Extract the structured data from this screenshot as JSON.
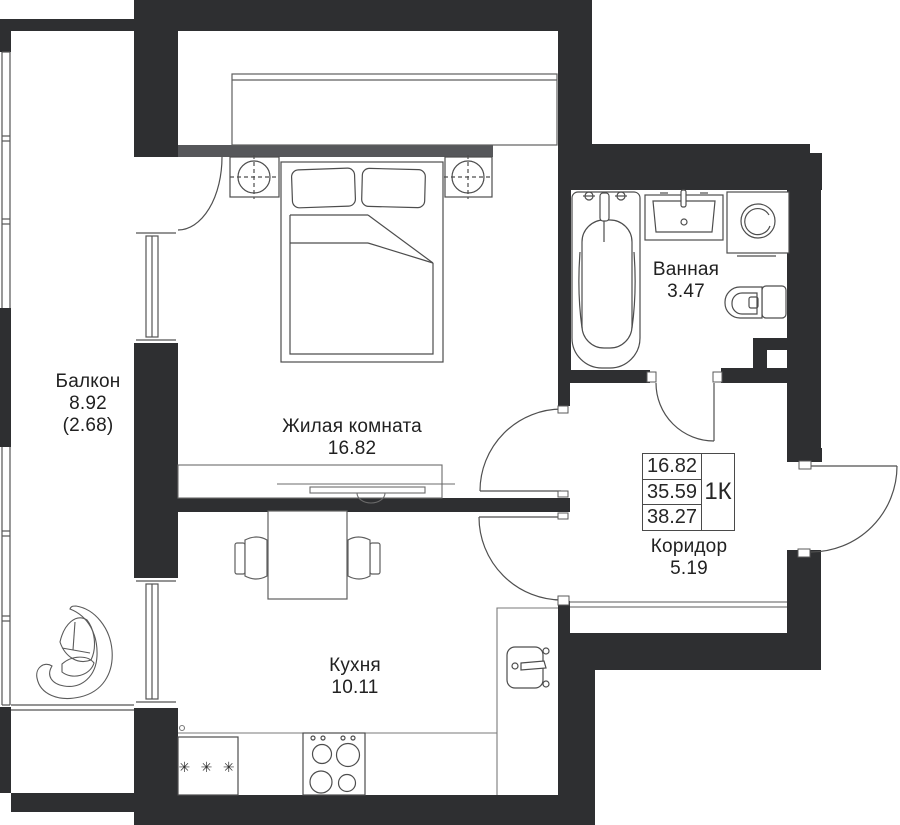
{
  "plan": {
    "unit_type": "1К",
    "summary": {
      "living_area": "16.82",
      "area_without_balcony": "35.59",
      "total_area": "38.27"
    },
    "rooms": {
      "balcony": {
        "name": "Балкон",
        "area": "8.92",
        "area_reduced": "(2.68)"
      },
      "living_room": {
        "name": "Жилая комната",
        "area": "16.82"
      },
      "bathroom": {
        "name": "Ванная",
        "area": "3.47"
      },
      "corridor": {
        "name": "Коридор",
        "area": "5.19"
      },
      "kitchen": {
        "name": "Кухня",
        "area": "10.11"
      }
    },
    "fixtures": {
      "fridge_symbol": "✳ ✳ ✳"
    },
    "colors": {
      "wall": "#2e2f31",
      "wardrobe_door": "#56575a",
      "line": "#4d4d4d",
      "text": "#212121",
      "background": "#ffffff"
    }
  }
}
